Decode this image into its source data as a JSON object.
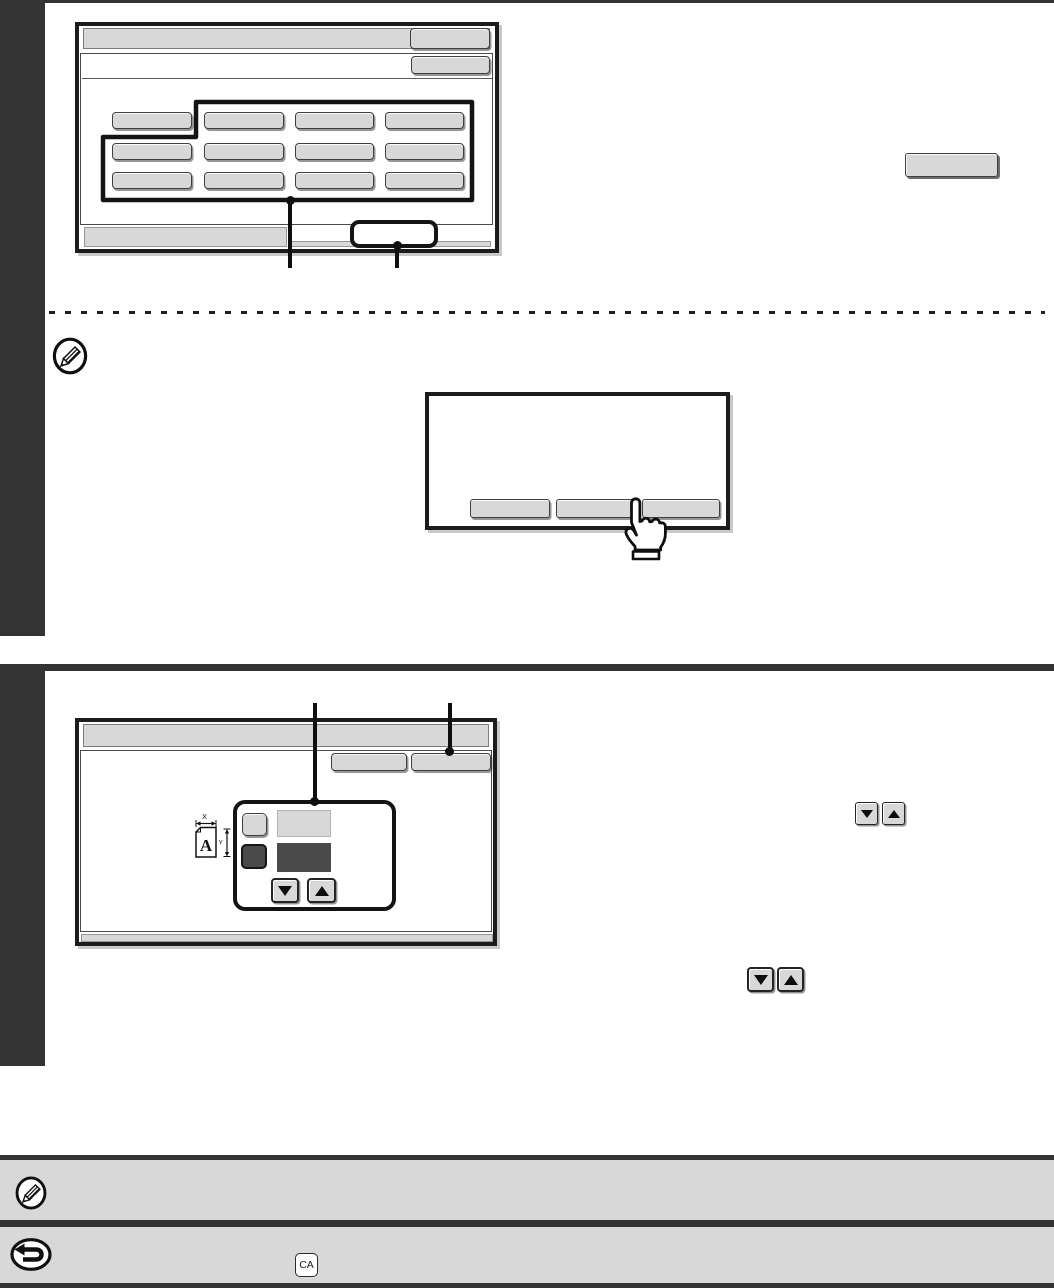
{
  "colors": {
    "dark": "#333333",
    "line": "#1a1a1a",
    "gray": "#d8d8d8",
    "darkfill": "#4a4a4a"
  },
  "icons": {
    "note": "pencil-in-circle-icon",
    "back": "return-arrow-in-circle-icon",
    "cursor": "pointing-hand-icon",
    "spinners": "up-down-arrow-buttons",
    "xy_document": "document-size-xy-icon"
  },
  "labels": {
    "ca_key": "CA"
  },
  "xy_icon": {
    "x_label": "X",
    "y_label": "Y",
    "page_letter": "A"
  },
  "screen1": {
    "title": "",
    "header_button": "",
    "sub_button": "",
    "grid_buttons": [
      "",
      "",
      "",
      "",
      "",
      "",
      "",
      "",
      "",
      "",
      "",
      ""
    ],
    "footer": ""
  },
  "popup": {
    "buttons": [
      "",
      "",
      ""
    ]
  },
  "screen2": {
    "title": "",
    "header_buttons": [
      "",
      ""
    ],
    "panel": {
      "top_button": "",
      "top_field": "",
      "bottom_button": "",
      "bottom_field": ""
    }
  },
  "standalone_button": ""
}
